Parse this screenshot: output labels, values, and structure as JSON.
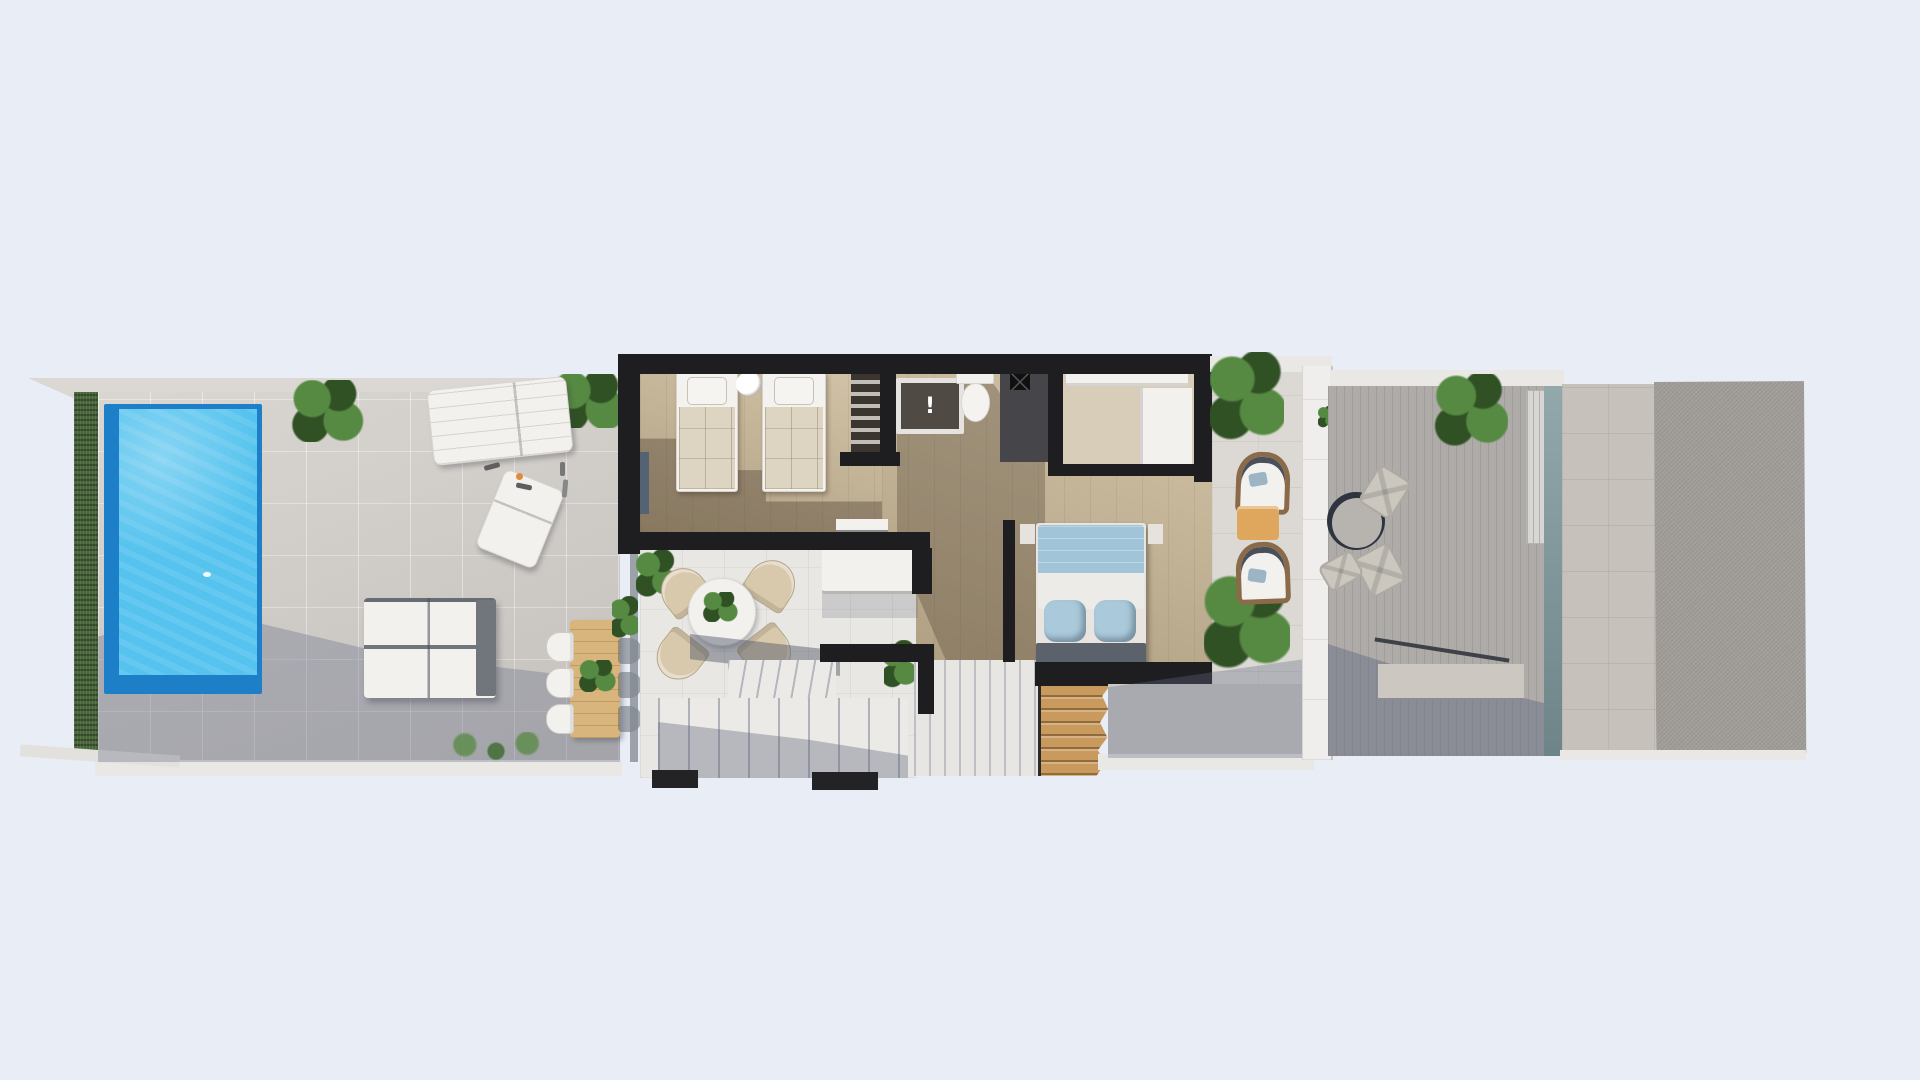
{
  "scene": {
    "description": "3D rendered top-down floor plan of an apartment level with pool terrace, bedrooms, bathroom, living room, staircase, balcony and roof deck",
    "rooms": [
      "pool-terrace",
      "twin-bedroom",
      "bathroom",
      "shower-room",
      "walk-in-closet",
      "hallway",
      "master-bedroom",
      "living-room",
      "staircase",
      "balcony",
      "roof-deck",
      "side-roof-volume"
    ],
    "furniture": [
      "swimming-pool",
      "garden-hedge",
      "sun-lounger",
      "outdoor-sofa",
      "outdoor-dining-table",
      "outdoor-chairs",
      "round-dining-table",
      "twin-beds",
      "bedside-lamp",
      "wardrobe",
      "washbasin",
      "toilet",
      "double-bed",
      "foot-bench",
      "wooden-stairs",
      "lounge-chairs",
      "side-table",
      "patio-table",
      "patio-chairs",
      "potted-plants",
      "planter-box",
      "glass-balustrade",
      "louver-panel"
    ]
  },
  "fixtures": {
    "sink_mark": "!"
  },
  "palette": {
    "bg": "#e9edf5",
    "roof_band": "#dbd8d4",
    "corner_slab": "#e3e1dd",
    "band_light": "#eae8e5",
    "hedge": "#48663a",
    "plant_hi": "#568a42",
    "plant_mid": "#47703a",
    "plant_lo": "#2f5124",
    "terrace_floor": "#cfcbc6",
    "pool_border": "#1d7fc7",
    "pool_water": "#55c3ee",
    "wall": "#1e1e20",
    "interior_floor": "#c9b796",
    "closet_floor": "#d7cdb8",
    "wardrobe_dark": "#3b3530",
    "shower_dark": "#46464a",
    "living_floor": "#e9e7e4",
    "white_furn": "#f2f1ee",
    "gray_back": "#70767c",
    "chair_beige": "#d8c9ac",
    "wood_table": "#d8b57c",
    "wood_stairs": "#c89a5e",
    "bed_duvet": "#a2c4d8",
    "bed_pillow": "#aac9da",
    "bench_gray": "#5b626c",
    "balcony_floor": "#dcd9d5",
    "balustrade": "#efeeec",
    "deck_floor": "#aeaba8",
    "stone": "#c6c1ba",
    "block": "#a19d99",
    "lounge_wood": "#8a6a48",
    "cushion_blue": "#9db4c4",
    "accent_table": "#dfa75e",
    "table_ring": "#2e3440",
    "table_top": "#b7b4b0",
    "glass_top": "#93a8ab",
    "glass_bottom": "#6e8488",
    "threshold": "#232326",
    "shadow_blue": "rgba(99,109,136,0.34)",
    "shadow_brown": "rgba(66,54,40,0.36)"
  }
}
